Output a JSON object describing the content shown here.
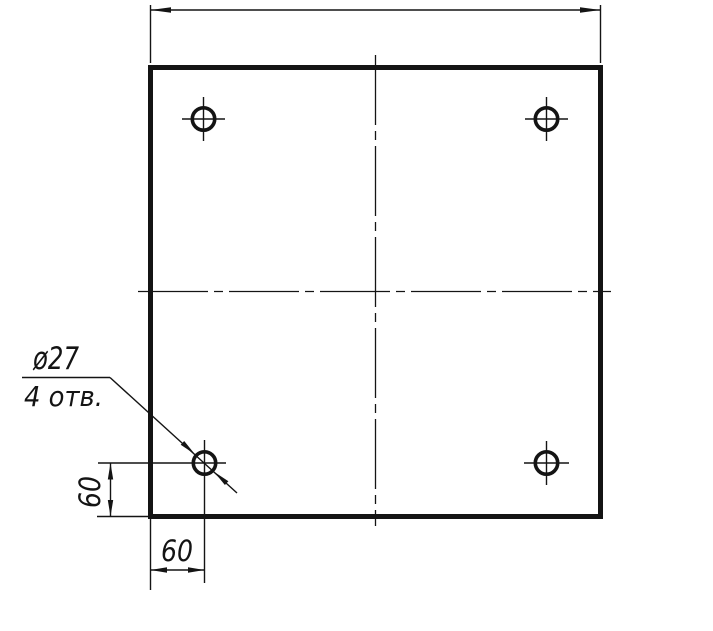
{
  "drawing": {
    "type": "engineering-drawing",
    "paper_color": "#ffffff",
    "ink_color": "#141414",
    "leader_note": {
      "diameter_label": "ø27",
      "holes_count_label": "4 отв."
    },
    "dimensions": {
      "hole_offset_vertical": "60",
      "hole_offset_horizontal": "60"
    }
  }
}
